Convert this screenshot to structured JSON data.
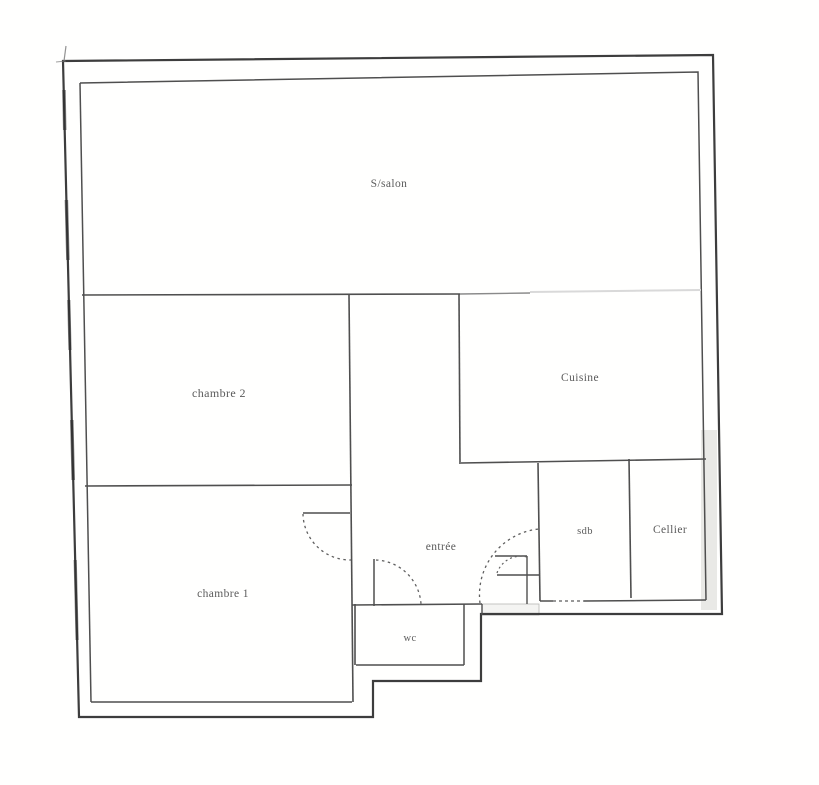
{
  "document_kind": "scanned apartment floor plan",
  "rooms": [
    {
      "id": "salon",
      "label": "S/salon"
    },
    {
      "id": "chambre2",
      "label": "chambre 2"
    },
    {
      "id": "cuisine",
      "label": "Cuisine"
    },
    {
      "id": "chambre1",
      "label": "chambre 1"
    },
    {
      "id": "entree",
      "label": "entrée"
    },
    {
      "id": "wc",
      "label": "wc"
    },
    {
      "id": "sdb",
      "label": "sdb"
    },
    {
      "id": "cellier",
      "label": "Cellier"
    }
  ],
  "colors": {
    "background": "#ffffff",
    "outer_wall": "#3d3d3d",
    "inner_wall": "#4f4f4f",
    "faded_wall": "#d9d9d9",
    "door_arc": "#5f5f5f",
    "label_text": "#454545",
    "wall_shading": "#e9e9e6"
  }
}
